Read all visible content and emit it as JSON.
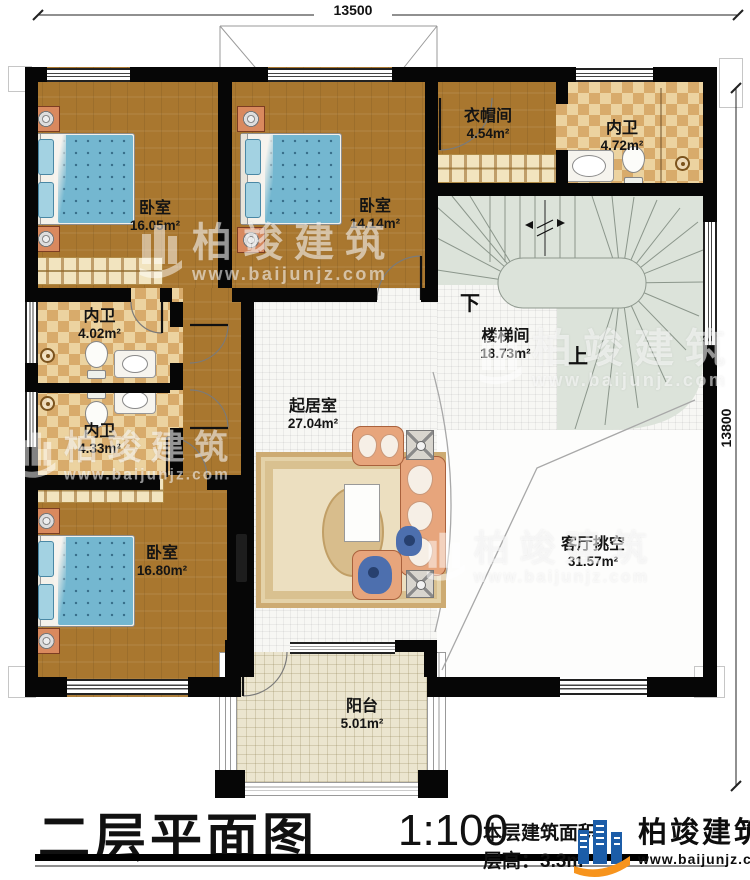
{
  "dimensions": {
    "top": "13500",
    "right": "13800"
  },
  "rooms": {
    "bedroom1": {
      "name": "卧室",
      "area": "16.05m²"
    },
    "bedroom2": {
      "name": "卧室",
      "area": "14.14m²"
    },
    "cloakroom": {
      "name": "衣帽间",
      "area": "4.54m²"
    },
    "bath_top": {
      "name": "内卫",
      "area": "4.72m²"
    },
    "stairwell": {
      "name": "楼梯间",
      "area": "18.73m²"
    },
    "bath_mid": {
      "name": "内卫",
      "area": "4.02m²"
    },
    "bath_low": {
      "name": "内卫",
      "area": "4.33m²"
    },
    "bedroom3": {
      "name": "卧室",
      "area": "16.80m²"
    },
    "living": {
      "name": "起居室",
      "area": "27.04m²"
    },
    "void": {
      "name": "客厅挑空",
      "area": "31.57m²"
    },
    "balcony": {
      "name": "阳台",
      "area": "5.01m²"
    }
  },
  "stairs": {
    "down": "下",
    "up": "上"
  },
  "title_block": {
    "title": "二层平面图",
    "scale": "1:100",
    "area_label": "本层建筑面积",
    "floor_height_label": "层高：3.3m"
  },
  "brand": {
    "name": "柏竣建筑",
    "url": "www.baijunjz.com"
  },
  "colors": {
    "accent_blue": "#1c5da8",
    "accent_orange": "#f7941d",
    "wall": "#060606",
    "wood": "#a9772f",
    "checker": "#d8ab6b",
    "stair_tile": "#dce3da",
    "balcony": "#ebe5cf",
    "bed": "#74b7d0",
    "sofa": "#e7a57c"
  }
}
